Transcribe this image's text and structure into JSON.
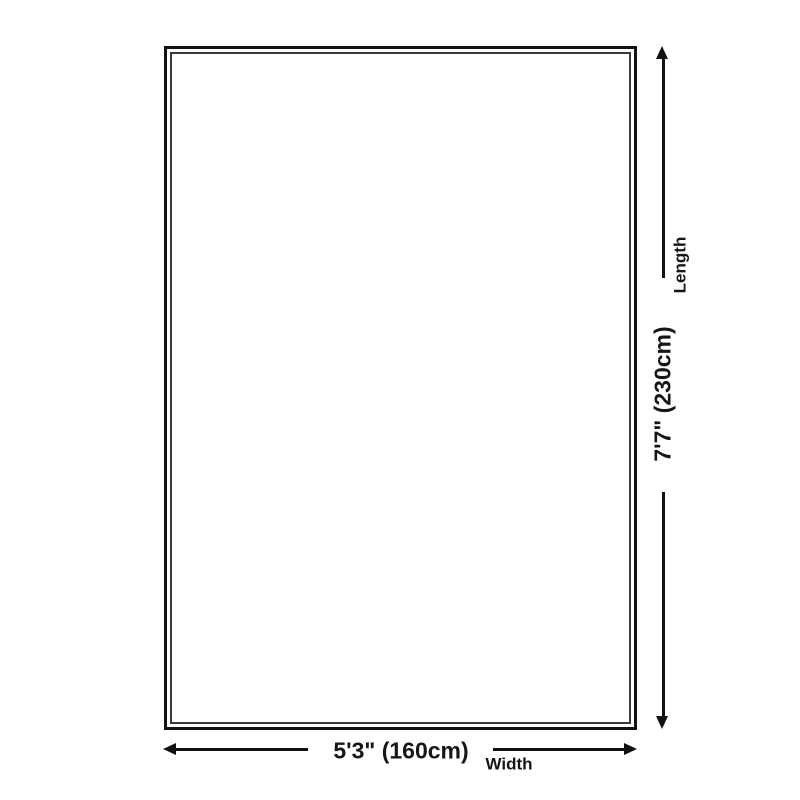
{
  "diagram": {
    "type": "product-size-diagram",
    "colors": {
      "background": "#ffffff",
      "line": "#111111",
      "outer_border": "#121212",
      "inner_border": "#3a3a3a",
      "text": "#161616"
    },
    "length": {
      "label": "Length",
      "value": "7'7\" (230cm)"
    },
    "width": {
      "label": "Width",
      "value": "5'3\" (160cm)"
    }
  }
}
